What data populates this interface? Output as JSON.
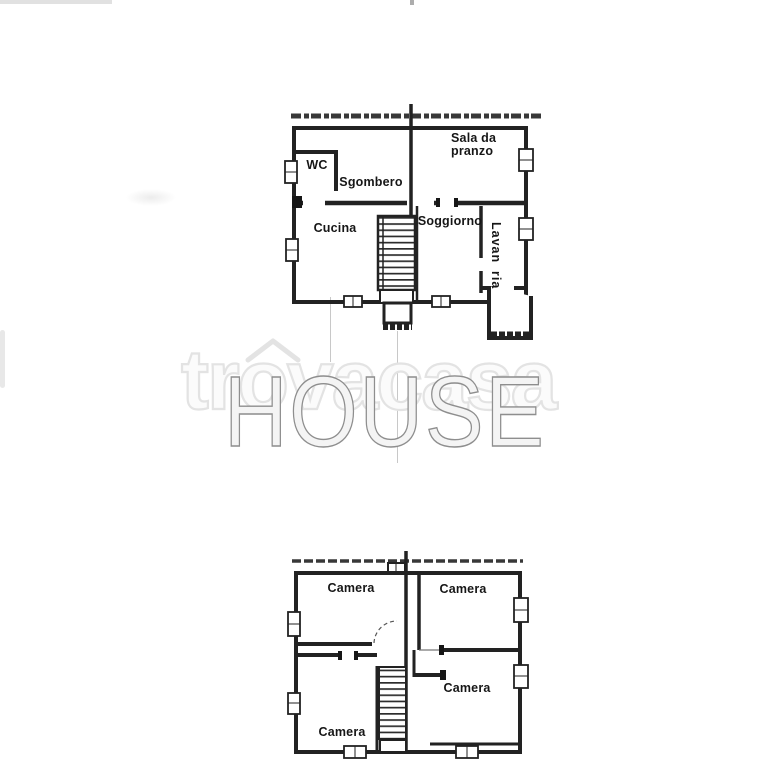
{
  "page": {
    "background": "#ffffff"
  },
  "watermarks": {
    "trovacasa_prefix": "tr",
    "trovacasa_o": "o",
    "trovacasa_suffix": "vacasa",
    "house": "HOUSE",
    "trovacasa_outline_color": "#e3e3e3",
    "house_outline_color": "#8e8e8e"
  },
  "upper_plan": {
    "rooms": {
      "wc": "WC",
      "sgombero": "Sgombero",
      "sala_da_pranzo": "Sala da pranzo",
      "cucina": "Cucina",
      "soggiorno": "Soggiorno",
      "lavanderia_part1": "Lavan",
      "lavanderia_part2": "ria"
    }
  },
  "lower_plan": {
    "rooms": {
      "camera_top_left": "Camera",
      "camera_top_right": "Camera",
      "camera_middle_right": "Camera",
      "camera_bottom_left": "Camera"
    }
  },
  "wall_color": "#222222"
}
